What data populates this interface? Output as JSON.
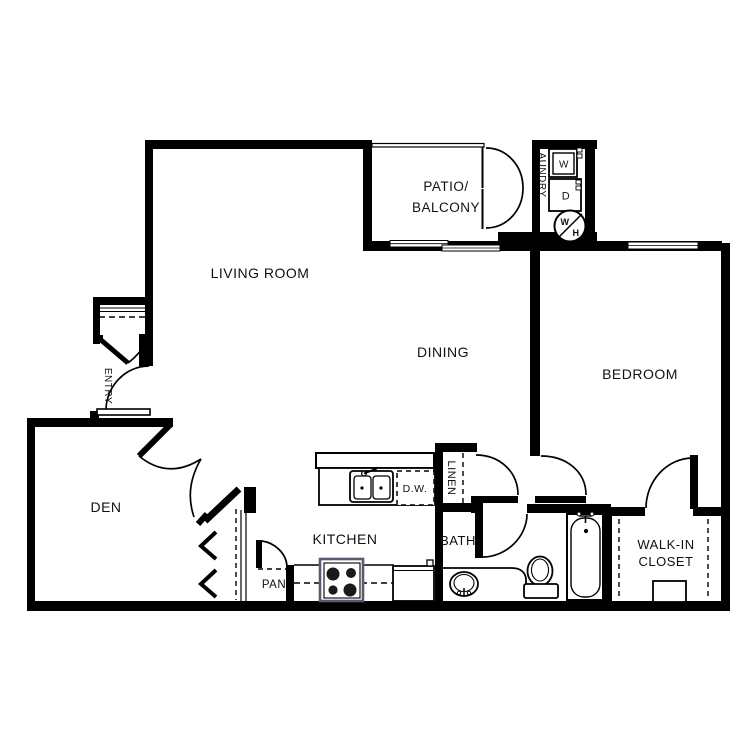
{
  "floor_plan": {
    "rooms": {
      "living_room": "LIVING ROOM",
      "dining": "DINING",
      "patio_line1": "PATIO/",
      "patio_line2": "BALCONY",
      "bedroom": "BEDROOM",
      "den": "DEN",
      "kitchen": "KITCHEN",
      "bath": "BATH",
      "laundry": "LAUNDRY",
      "entry": "ENTRY",
      "linen": "LINEN",
      "pantry": "PAN",
      "walk_in_line1": "WALK-IN",
      "walk_in_line2": "CLOSET"
    },
    "appliances": {
      "washer": "W",
      "dryer": "D",
      "dishwasher": "D.W.",
      "water_heater_w": "W",
      "water_heater_h": "H"
    },
    "colors": {
      "wall": "#000000",
      "background": "#ffffff",
      "stove_accent": "#565c6e"
    }
  }
}
